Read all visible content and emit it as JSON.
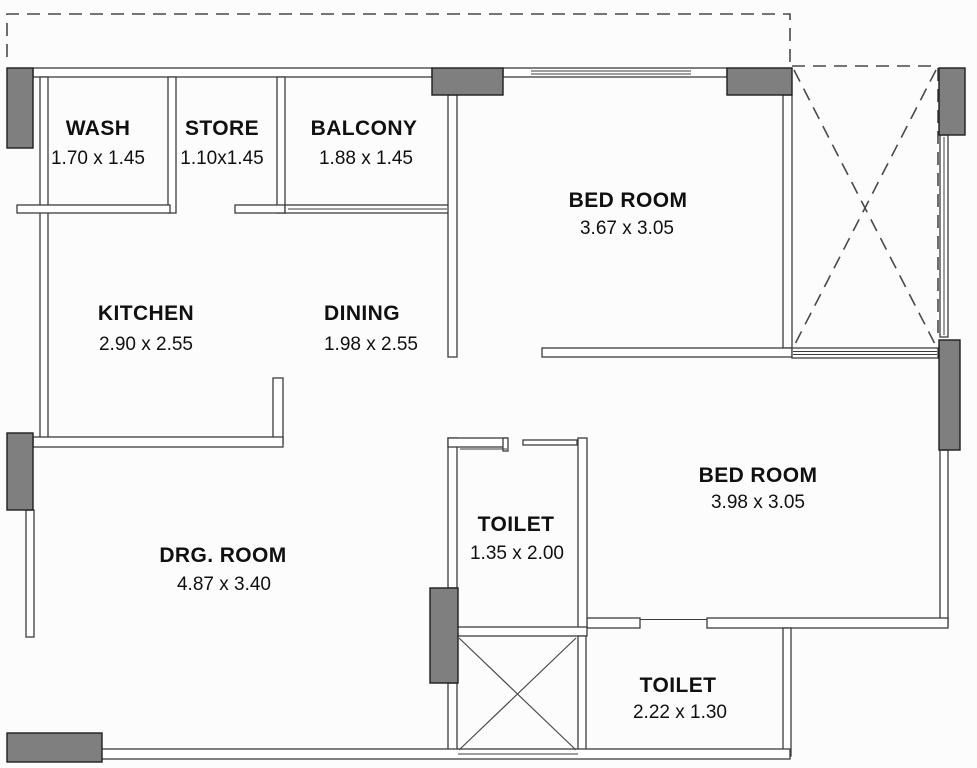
{
  "plan": {
    "rooms": [
      {
        "name": "WASH",
        "dims": "1.70 x 1.45"
      },
      {
        "name": "STORE",
        "dims": "1.10x1.45"
      },
      {
        "name": "BALCONY",
        "dims": "1.88 x 1.45"
      },
      {
        "name": "BED ROOM",
        "dims": "3.67 x 3.05"
      },
      {
        "name": "KITCHEN",
        "dims": "2.90 x 2.55"
      },
      {
        "name": "DINING",
        "dims": "1.98 x 2.55"
      },
      {
        "name": "DRG. ROOM",
        "dims": "4.87 x 3.40"
      },
      {
        "name": "TOILET",
        "dims": "1.35 x 2.00"
      },
      {
        "name": "BED ROOM",
        "dims": "3.98 x 3.05"
      },
      {
        "name": "TOILET",
        "dims": "2.22 x 1.30"
      }
    ],
    "features": {
      "open_terrace_marker": "dashed-x-cross",
      "duct_shaft_marker": "solid-x-cross",
      "property_boundary": "dashed-line"
    },
    "colors": {
      "wall_line": "#3c3c3c",
      "column_fill": "#7f7f7f",
      "background": "#fcfcfc",
      "text": "#101010"
    }
  }
}
